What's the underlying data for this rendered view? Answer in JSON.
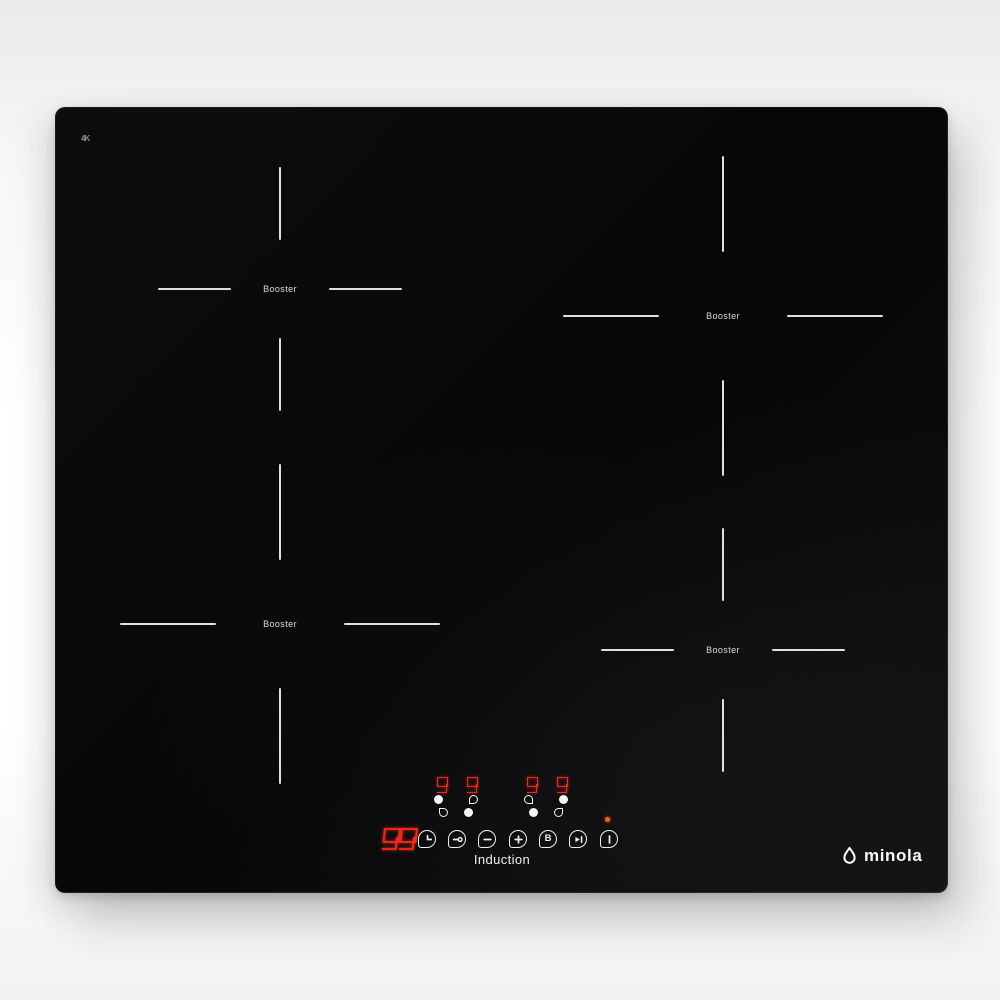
{
  "product": {
    "type": "induction cooktop product photo",
    "brand": "minola",
    "panel_label": "Induction",
    "corner_mark": "4K"
  },
  "zones": [
    {
      "label": "Booster",
      "position": "back-left",
      "size": "standard"
    },
    {
      "label": "Booster",
      "position": "back-right",
      "size": "large"
    },
    {
      "label": "Booster",
      "position": "front-left",
      "size": "large"
    },
    {
      "label": "Booster",
      "position": "front-right",
      "size": "standard"
    }
  ],
  "displays": {
    "zone_power_levels": [
      "9",
      "9",
      "9",
      "9"
    ],
    "timer_display": "99"
  },
  "controls": {
    "zone_selectors": [
      {
        "name": "select-zone-1",
        "filled_dot": "top-left"
      },
      {
        "name": "select-zone-2",
        "filled_dot": "bottom-left"
      },
      {
        "name": "select-zone-3",
        "filled_dot": "bottom-right"
      },
      {
        "name": "select-zone-4",
        "filled_dot": "top-right"
      }
    ],
    "buttons": [
      {
        "name": "timer",
        "icon": "clock-icon"
      },
      {
        "name": "child-lock",
        "icon": "key-icon"
      },
      {
        "name": "power-down",
        "icon": "minus-icon"
      },
      {
        "name": "power-up",
        "icon": "plus-icon"
      },
      {
        "name": "booster",
        "label": "B"
      },
      {
        "name": "stop-and-go",
        "icon": "play-pause-icon"
      },
      {
        "name": "power",
        "icon": "power-bar-icon"
      }
    ],
    "power_indicator": "on"
  },
  "colors": {
    "led_red": "#f42718",
    "indicator_orange": "#ff5c1e",
    "marking_white": "#eceff1",
    "glass_black": "#0a0a0b"
  }
}
